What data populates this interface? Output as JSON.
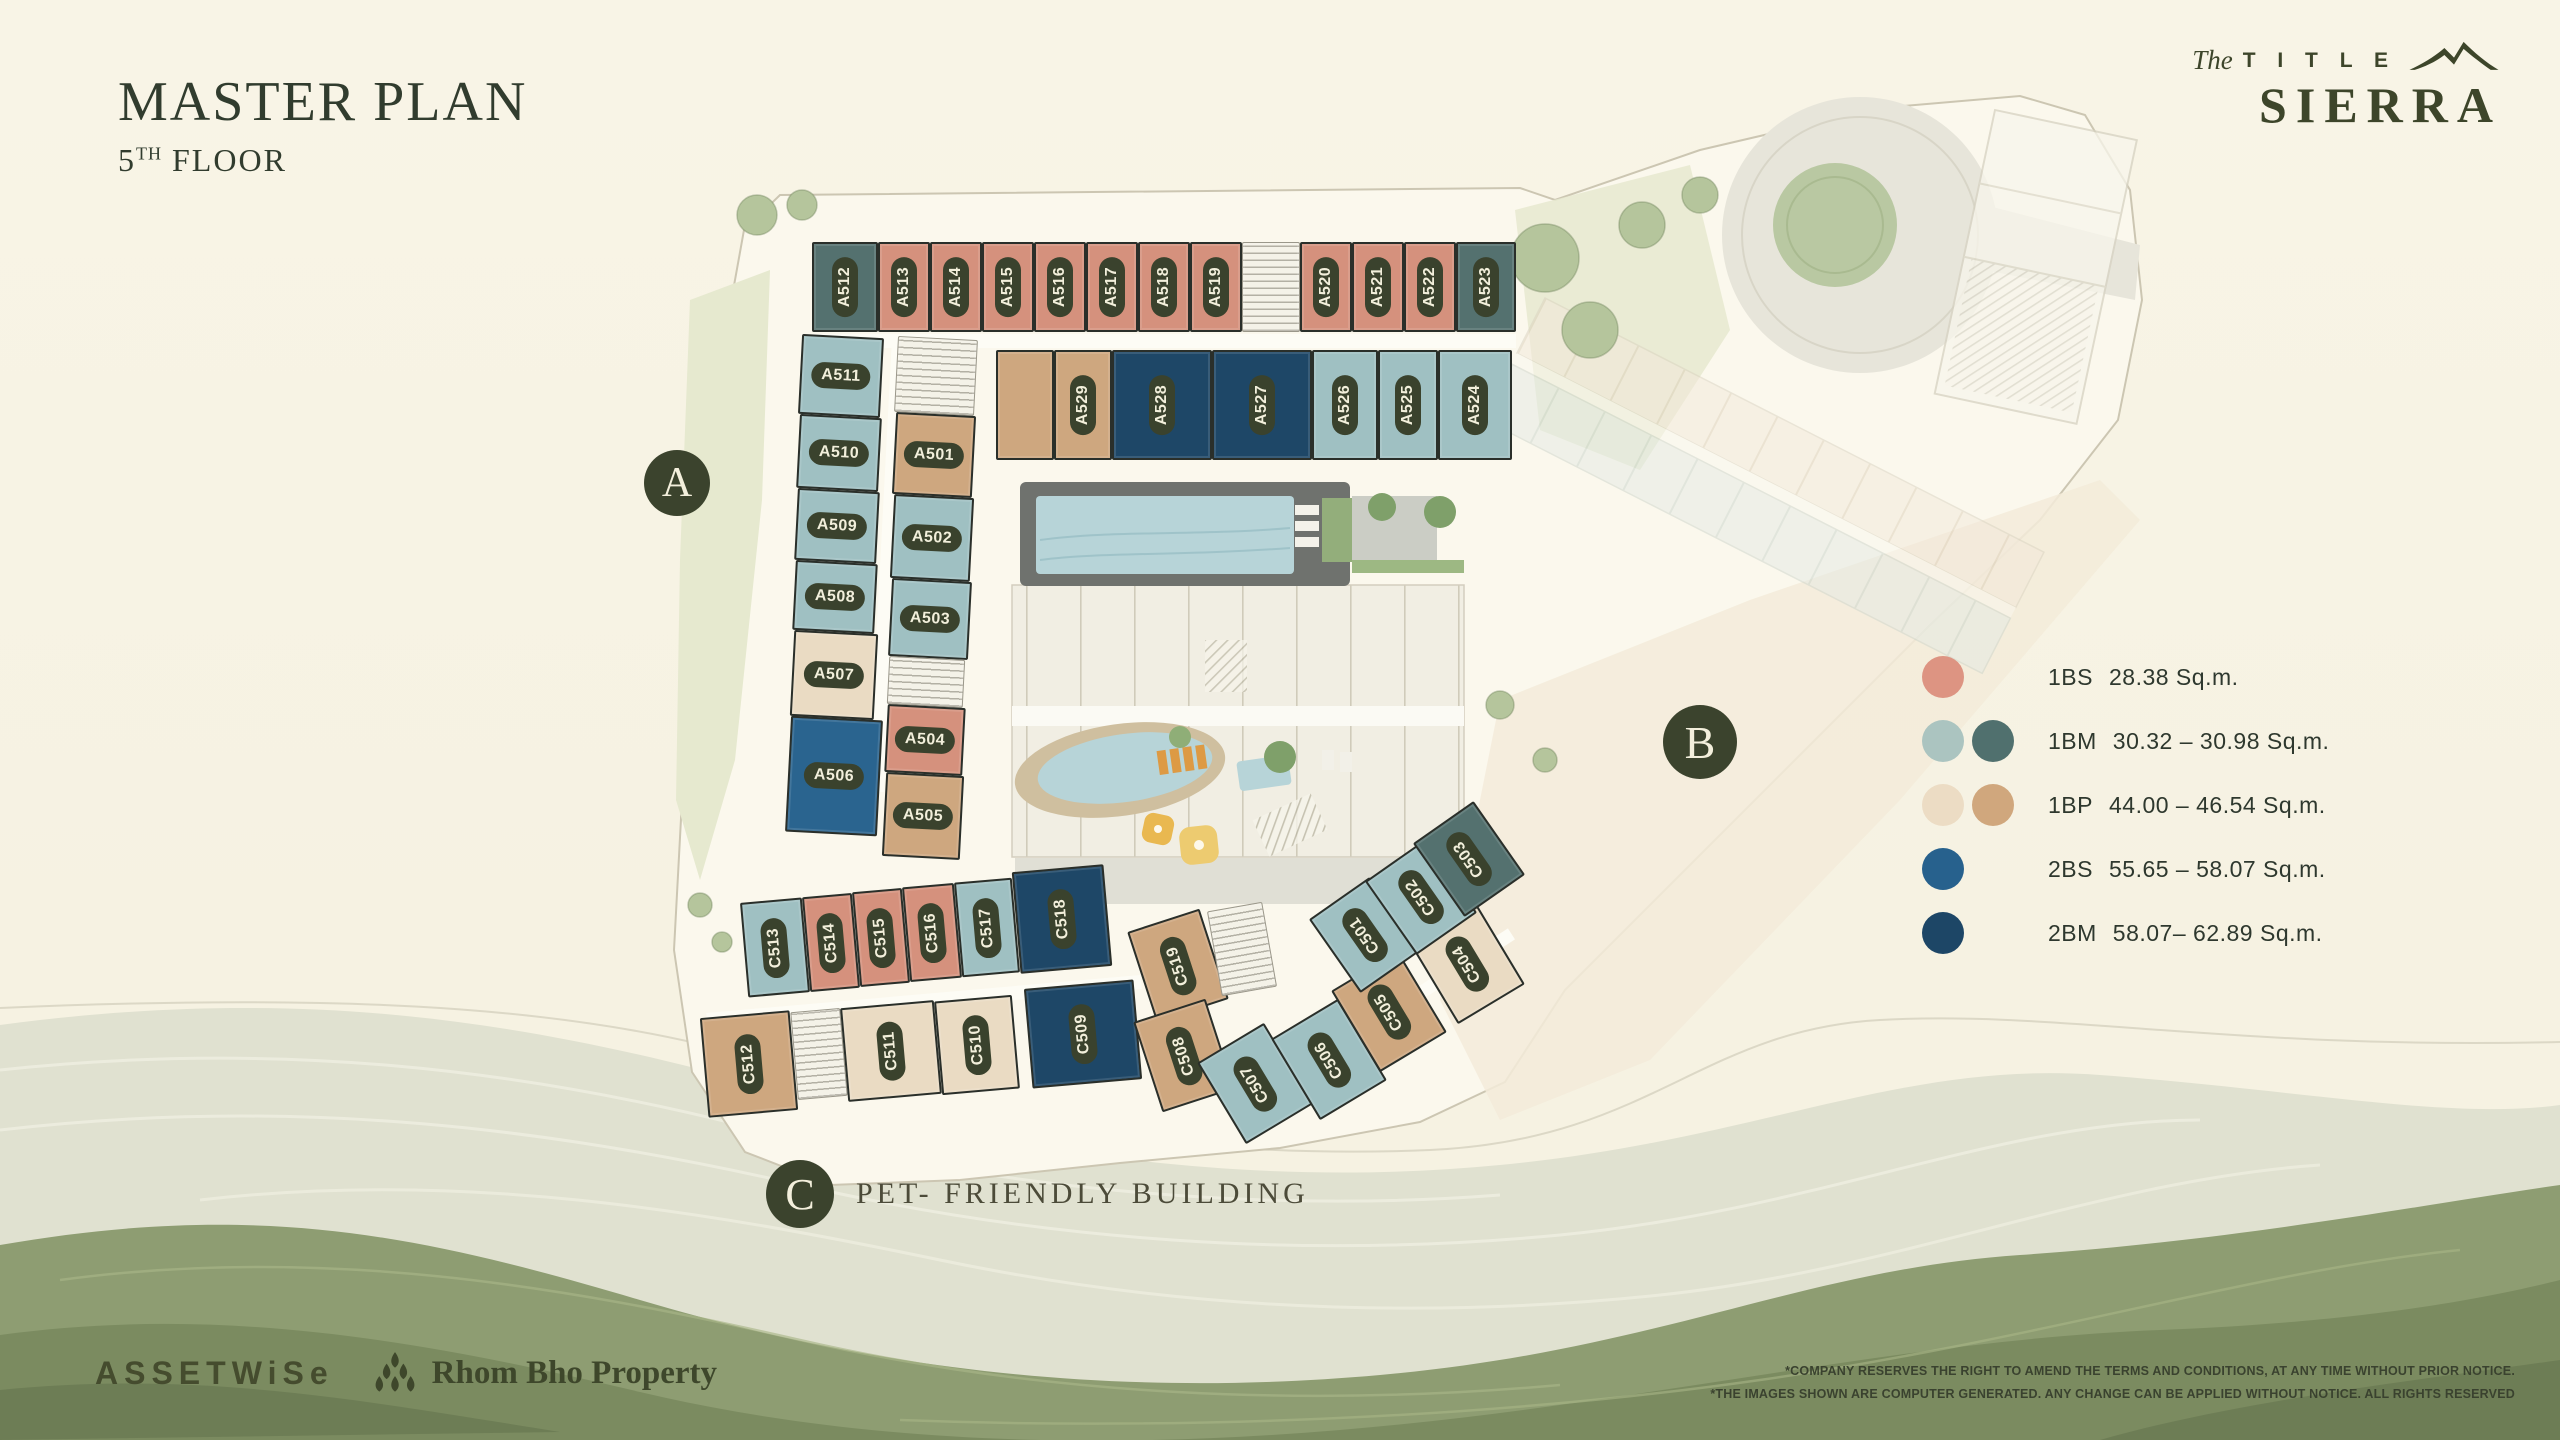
{
  "header": {
    "title": "MASTER PLAN",
    "floor_num": "5",
    "floor_sup": "TH",
    "floor_rest": " FLOOR"
  },
  "brand": {
    "the": "The",
    "title_word": "T I T L E",
    "name": "SIERRA"
  },
  "legend": {
    "items": [
      {
        "code": "1BS",
        "range": "28.38 Sq.m.",
        "colors": [
          "#dd9482"
        ]
      },
      {
        "code": "1BM",
        "range": "30.32 – 30.98 Sq.m.",
        "colors": [
          "#abc4c0",
          "#50706e"
        ]
      },
      {
        "code": "1BP",
        "range": "44.00 – 46.54 Sq.m.",
        "colors": [
          "#ecdcc4",
          "#d0a77d"
        ]
      },
      {
        "code": "2BS",
        "range": "55.65 – 58.07 Sq.m.",
        "colors": [
          "#27618d"
        ]
      },
      {
        "code": "2BM",
        "range": "58.07– 62.89 Sq.m.",
        "colors": [
          "#1d4666"
        ]
      }
    ]
  },
  "badges": {
    "a": "A",
    "b": "B",
    "c": "C",
    "pet_note": "PET- FRIENDLY BUILDING"
  },
  "palette": {
    "1BS": "#d5917d",
    "1BM": "#9fc0c2",
    "1BM-d": "#54716f",
    "1BP": "#eadbc3",
    "1BP-d": "#cea77f",
    "2BS": "#2a648f",
    "2BM": "#1e4767",
    "accent_dark": "#3b432d",
    "pool": "#b7d4d8",
    "site": "#fbf8ed"
  },
  "units": [
    {
      "id": "",
      "x": 812,
      "y": 334,
      "w": 704,
      "h": 14,
      "t": "cor",
      "rot": 0,
      "d": "h"
    },
    {
      "id": "",
      "x": 880,
      "y": 342,
      "w": 16,
      "h": 450,
      "t": "cor",
      "rot": 3,
      "d": "h"
    },
    {
      "id": "",
      "x": 706,
      "y": 994,
      "w": 436,
      "h": 14,
      "t": "cor",
      "rot": -5,
      "d": "h"
    },
    {
      "id": "",
      "x": 1300,
      "y": 990,
      "w": 230,
      "h": 13,
      "t": "cor",
      "rot": -33,
      "d": "h"
    },
    {
      "id": "A512",
      "x": 812,
      "y": 242,
      "w": 66,
      "h": 90,
      "t": "1BM-d",
      "rot": 0,
      "d": "v"
    },
    {
      "id": "A513",
      "x": 878,
      "y": 242,
      "w": 52,
      "h": 90,
      "t": "1BS",
      "rot": 0,
      "d": "v"
    },
    {
      "id": "A514",
      "x": 930,
      "y": 242,
      "w": 52,
      "h": 90,
      "t": "1BS",
      "rot": 0,
      "d": "v"
    },
    {
      "id": "A515",
      "x": 982,
      "y": 242,
      "w": 52,
      "h": 90,
      "t": "1BS",
      "rot": 0,
      "d": "v"
    },
    {
      "id": "A516",
      "x": 1034,
      "y": 242,
      "w": 52,
      "h": 90,
      "t": "1BS",
      "rot": 0,
      "d": "v"
    },
    {
      "id": "A517",
      "x": 1086,
      "y": 242,
      "w": 52,
      "h": 90,
      "t": "1BS",
      "rot": 0,
      "d": "v"
    },
    {
      "id": "A518",
      "x": 1138,
      "y": 242,
      "w": 52,
      "h": 90,
      "t": "1BS",
      "rot": 0,
      "d": "v"
    },
    {
      "id": "A519",
      "x": 1190,
      "y": 242,
      "w": 52,
      "h": 90,
      "t": "1BS",
      "rot": 0,
      "d": "v"
    },
    {
      "id": "",
      "x": 1242,
      "y": 242,
      "w": 58,
      "h": 90,
      "t": "st",
      "rot": 0,
      "d": "v"
    },
    {
      "id": "A520",
      "x": 1300,
      "y": 242,
      "w": 52,
      "h": 90,
      "t": "1BS",
      "rot": 0,
      "d": "v"
    },
    {
      "id": "A521",
      "x": 1352,
      "y": 242,
      "w": 52,
      "h": 90,
      "t": "1BS",
      "rot": 0,
      "d": "v"
    },
    {
      "id": "A522",
      "x": 1404,
      "y": 242,
      "w": 52,
      "h": 90,
      "t": "1BS",
      "rot": 0,
      "d": "v"
    },
    {
      "id": "A523",
      "x": 1456,
      "y": 242,
      "w": 60,
      "h": 90,
      "t": "1BM-d",
      "rot": 0,
      "d": "v"
    },
    {
      "id": "",
      "x": 996,
      "y": 350,
      "w": 58,
      "h": 110,
      "t": "1BP-d",
      "rot": 0,
      "d": "v"
    },
    {
      "id": "A529",
      "x": 1054,
      "y": 350,
      "w": 58,
      "h": 110,
      "t": "1BP-d",
      "rot": 0,
      "d": "v"
    },
    {
      "id": "A528",
      "x": 1112,
      "y": 350,
      "w": 100,
      "h": 110,
      "t": "2BM",
      "rot": 0,
      "d": "v"
    },
    {
      "id": "A527",
      "x": 1212,
      "y": 350,
      "w": 100,
      "h": 110,
      "t": "2BM",
      "rot": 0,
      "d": "v"
    },
    {
      "id": "A526",
      "x": 1312,
      "y": 350,
      "w": 66,
      "h": 110,
      "t": "1BM",
      "rot": 0,
      "d": "v"
    },
    {
      "id": "A525",
      "x": 1378,
      "y": 350,
      "w": 60,
      "h": 110,
      "t": "1BM",
      "rot": 0,
      "d": "v"
    },
    {
      "id": "A524",
      "x": 1438,
      "y": 350,
      "w": 74,
      "h": 110,
      "t": "1BM",
      "rot": 0,
      "d": "v"
    },
    {
      "id": "A511",
      "x": 800,
      "y": 336,
      "w": 82,
      "h": 80,
      "t": "1BM",
      "rot": 3,
      "d": "h"
    },
    {
      "id": "A510",
      "x": 798,
      "y": 416,
      "w": 82,
      "h": 74,
      "t": "1BM",
      "rot": 3,
      "d": "h"
    },
    {
      "id": "A509",
      "x": 796,
      "y": 490,
      "w": 82,
      "h": 72,
      "t": "1BM",
      "rot": 3,
      "d": "h"
    },
    {
      "id": "A508",
      "x": 794,
      "y": 562,
      "w": 82,
      "h": 70,
      "t": "1BM",
      "rot": 3,
      "d": "h"
    },
    {
      "id": "A507",
      "x": 792,
      "y": 632,
      "w": 84,
      "h": 86,
      "t": "1BP",
      "rot": 3,
      "d": "h"
    },
    {
      "id": "A506",
      "x": 788,
      "y": 718,
      "w": 92,
      "h": 116,
      "t": "2BS",
      "rot": 3,
      "d": "h"
    },
    {
      "id": "",
      "x": 896,
      "y": 338,
      "w": 80,
      "h": 76,
      "t": "st",
      "rot": 3,
      "d": "h"
    },
    {
      "id": "A501",
      "x": 894,
      "y": 414,
      "w": 80,
      "h": 82,
      "t": "1BP-d",
      "rot": 3,
      "d": "h"
    },
    {
      "id": "A502",
      "x": 892,
      "y": 496,
      "w": 80,
      "h": 84,
      "t": "1BM",
      "rot": 3,
      "d": "h"
    },
    {
      "id": "A503",
      "x": 890,
      "y": 580,
      "w": 80,
      "h": 78,
      "t": "1BM",
      "rot": 3,
      "d": "h"
    },
    {
      "id": "",
      "x": 888,
      "y": 658,
      "w": 76,
      "h": 48,
      "t": "st",
      "rot": 3,
      "d": "h"
    },
    {
      "id": "A504",
      "x": 886,
      "y": 706,
      "w": 78,
      "h": 68,
      "t": "1BS",
      "rot": 3,
      "d": "h"
    },
    {
      "id": "A505",
      "x": 884,
      "y": 774,
      "w": 78,
      "h": 84,
      "t": "1BP-d",
      "rot": 3,
      "d": "h"
    },
    {
      "id": "C513",
      "x": 744,
      "y": 900,
      "w": 62,
      "h": 95,
      "t": "1BM",
      "rot": -5,
      "d": "v"
    },
    {
      "id": "C514",
      "x": 806,
      "y": 895,
      "w": 50,
      "h": 95,
      "t": "1BS",
      "rot": -5,
      "d": "v"
    },
    {
      "id": "C515",
      "x": 856,
      "y": 890,
      "w": 50,
      "h": 95,
      "t": "1BS",
      "rot": -5,
      "d": "v"
    },
    {
      "id": "C516",
      "x": 906,
      "y": 885,
      "w": 52,
      "h": 95,
      "t": "1BS",
      "rot": -5,
      "d": "v"
    },
    {
      "id": "C517",
      "x": 958,
      "y": 880,
      "w": 58,
      "h": 95,
      "t": "1BM",
      "rot": -5,
      "d": "v"
    },
    {
      "id": "C518",
      "x": 1016,
      "y": 868,
      "w": 92,
      "h": 102,
      "t": "2BM",
      "rot": -5,
      "d": "v"
    },
    {
      "id": "C512",
      "x": 704,
      "y": 1014,
      "w": 90,
      "h": 100,
      "t": "1BP-d",
      "rot": -5,
      "d": "v"
    },
    {
      "id": "",
      "x": 794,
      "y": 1010,
      "w": 50,
      "h": 88,
      "t": "st",
      "rot": -5,
      "d": "v"
    },
    {
      "id": "C511",
      "x": 844,
      "y": 1004,
      "w": 94,
      "h": 94,
      "t": "1BP",
      "rot": -5,
      "d": "v"
    },
    {
      "id": "C510",
      "x": 938,
      "y": 998,
      "w": 78,
      "h": 94,
      "t": "1BP",
      "rot": -5,
      "d": "v"
    },
    {
      "id": "C509",
      "x": 1028,
      "y": 984,
      "w": 110,
      "h": 100,
      "t": "2BM",
      "rot": -5,
      "d": "v"
    },
    {
      "id": "C519",
      "x": 1140,
      "y": 918,
      "w": 76,
      "h": 95,
      "t": "1BP-d",
      "rot": -18,
      "d": "v"
    },
    {
      "id": "C508",
      "x": 1146,
      "y": 1008,
      "w": 76,
      "h": 95,
      "t": "1BP-d",
      "rot": -18,
      "d": "v"
    },
    {
      "id": "",
      "x": 1214,
      "y": 906,
      "w": 56,
      "h": 86,
      "t": "st",
      "rot": -10,
      "d": "v"
    },
    {
      "id": "C507",
      "x": 1216,
      "y": 1036,
      "w": 78,
      "h": 95,
      "t": "1BM",
      "rot": -31,
      "d": "v"
    },
    {
      "id": "C506",
      "x": 1290,
      "y": 1012,
      "w": 78,
      "h": 95,
      "t": "1BM",
      "rot": -31,
      "d": "v"
    },
    {
      "id": "C505",
      "x": 1350,
      "y": 964,
      "w": 78,
      "h": 95,
      "t": "1BP-d",
      "rot": -31,
      "d": "v"
    },
    {
      "id": "C504",
      "x": 1428,
      "y": 916,
      "w": 78,
      "h": 95,
      "t": "1BP",
      "rot": -31,
      "d": "v"
    },
    {
      "id": "C501",
      "x": 1328,
      "y": 890,
      "w": 74,
      "h": 90,
      "t": "1BM",
      "rot": -35,
      "d": "v"
    },
    {
      "id": "C502",
      "x": 1384,
      "y": 852,
      "w": 74,
      "h": 90,
      "t": "1BM",
      "rot": -35,
      "d": "v"
    },
    {
      "id": "C503",
      "x": 1432,
      "y": 814,
      "w": 74,
      "h": 90,
      "t": "1BM-d",
      "rot": -35,
      "d": "v"
    }
  ],
  "footer": {
    "assetwise": "ASSETWiSe",
    "partner": "Rhom Bho Property",
    "disclaimer_line1": "*COMPANY RESERVES THE RIGHT TO AMEND THE TERMS AND CONDITIONS, AT ANY TIME WITHOUT PRIOR NOTICE.",
    "disclaimer_line2": "*THE IMAGES SHOWN ARE COMPUTER GENERATED. ANY CHANGE CAN BE APPLIED WITHOUT NOTICE. ALL RIGHTS RESERVED"
  }
}
